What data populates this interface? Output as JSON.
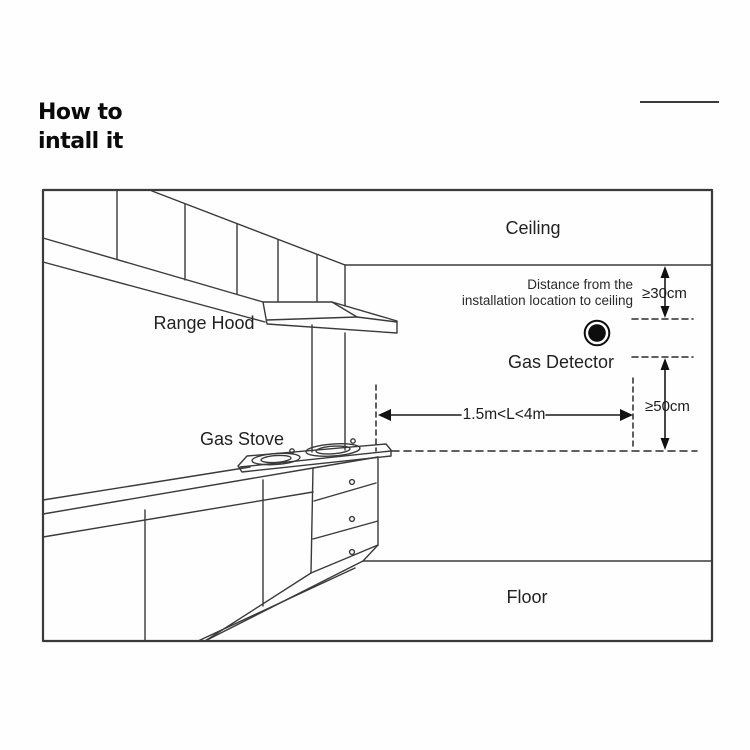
{
  "header": {
    "title_line1": "How to",
    "title_line2": "intall it"
  },
  "diagram": {
    "labels": {
      "ceiling": "Ceiling",
      "range_hood": "Range Hood",
      "gas_stove": "Gas Stove",
      "gas_detector": "Gas Detector",
      "floor": "Floor"
    },
    "annotations": {
      "note_line1": "Distance from the",
      "note_line2": "installation location to ceiling",
      "dim_ceiling_clearance": "≥30cm",
      "dim_stove_clearance": "≥50cm",
      "dim_horizontal_range": "1.5m<L<4m"
    },
    "colors": {
      "line": "#3a3a3a",
      "text": "#222222",
      "detector": "#0d0d0d"
    }
  }
}
